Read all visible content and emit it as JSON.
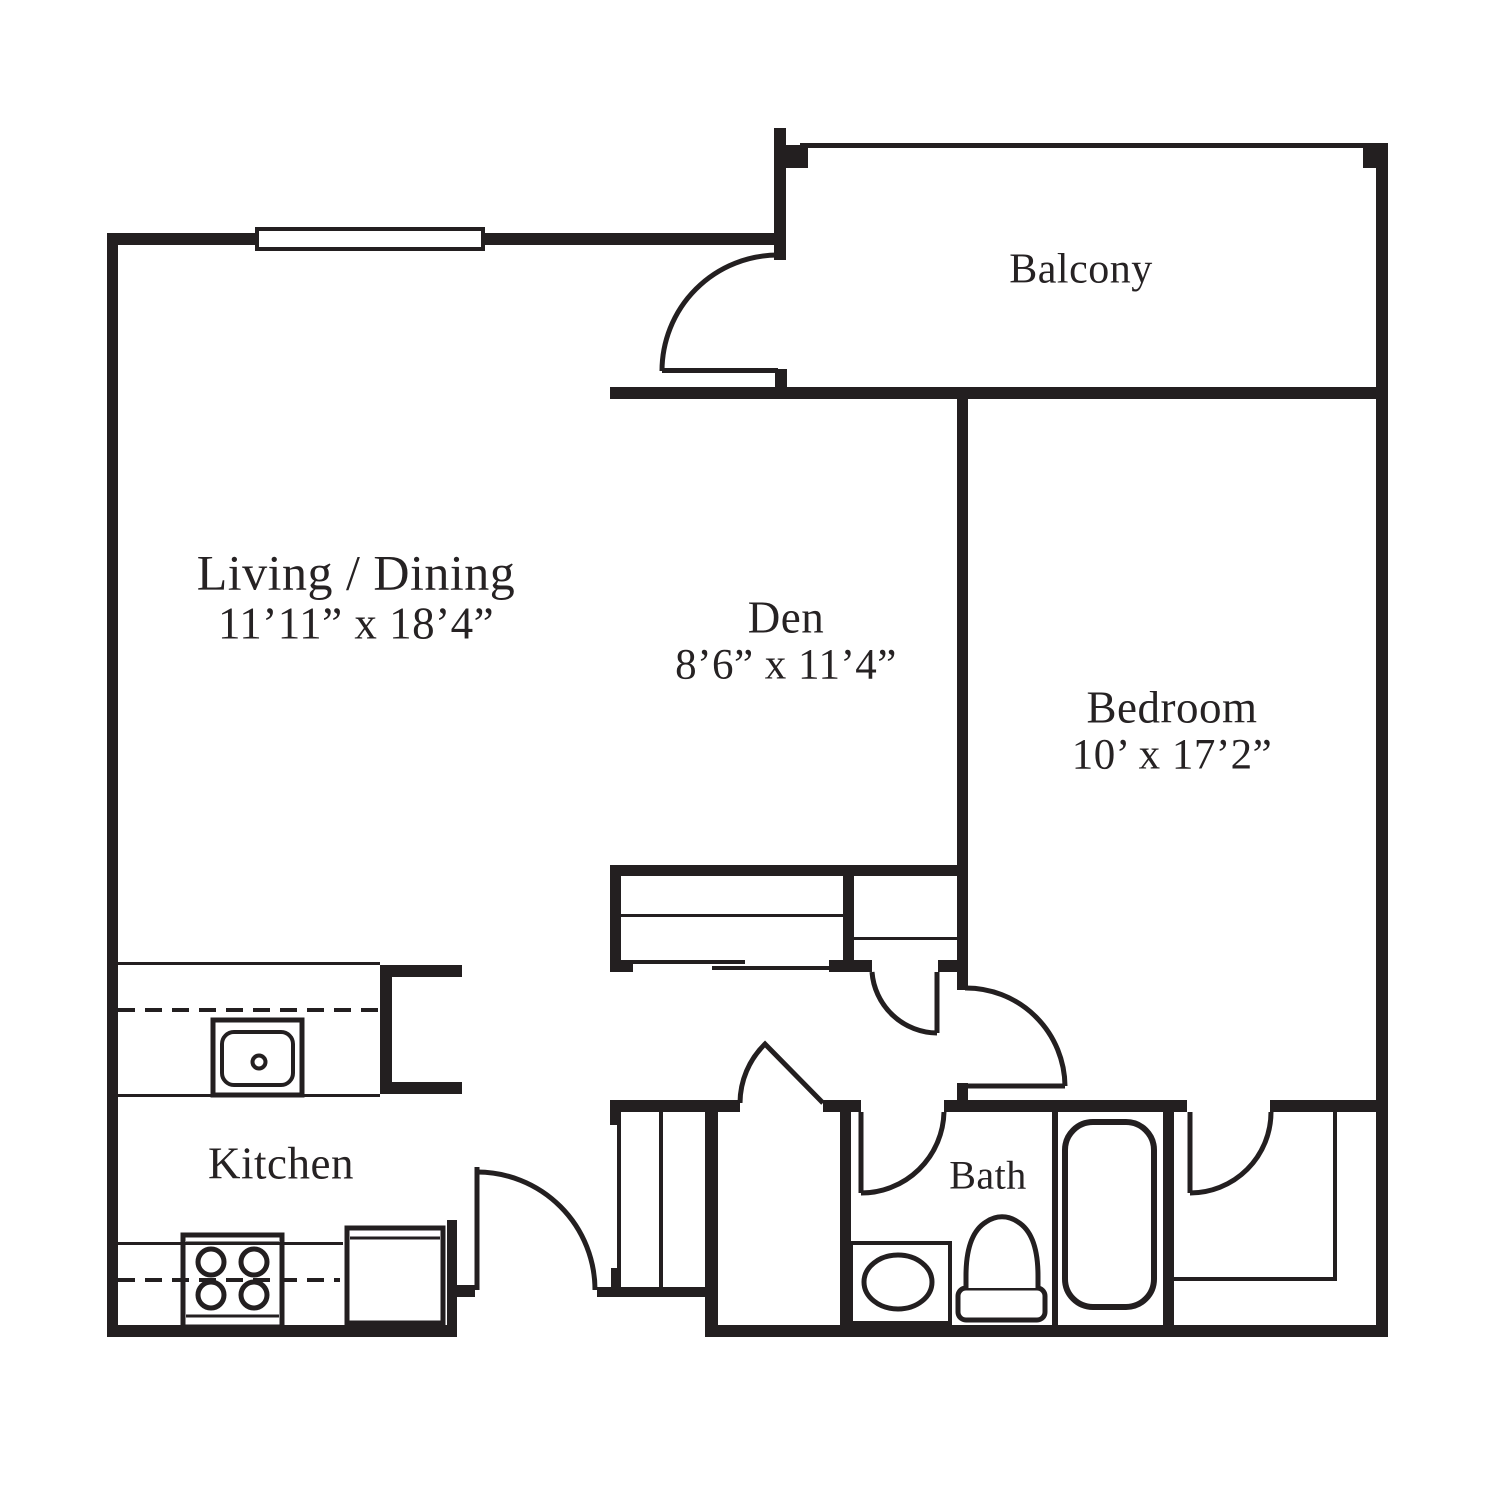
{
  "title": "One-bedroom with den apartment floor plan",
  "colors": {
    "wall": "#231f20",
    "text": "#262223",
    "background": "#ffffff"
  },
  "rooms": {
    "balcony": {
      "label": "Balcony"
    },
    "living_dining": {
      "label": "Living / Dining",
      "dims": "11’11” x 18’4”"
    },
    "den": {
      "label": "Den",
      "dims": "8’6” x 11’4”"
    },
    "bedroom": {
      "label": "Bedroom",
      "dims": "10’ x 17’2”"
    },
    "kitchen": {
      "label": "Kitchen"
    },
    "bath": {
      "label": "Bath"
    }
  },
  "fixtures": [
    "kitchen-sink",
    "range-burners",
    "refrigerator",
    "bathroom-sink",
    "toilet",
    "bathtub"
  ],
  "features": [
    "window",
    "balcony-door",
    "entry-door",
    "hall-storage-door",
    "bath-door",
    "bedroom-door",
    "bedroom-closet-door",
    "hall-closet-door",
    "den-closet-sliding-doors",
    "entry-closet-front"
  ]
}
